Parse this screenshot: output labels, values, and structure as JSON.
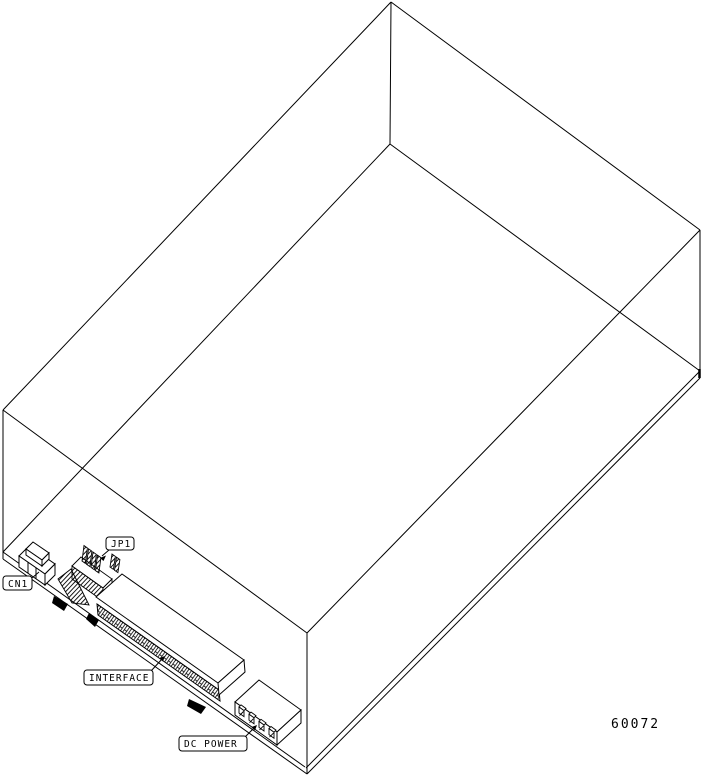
{
  "figure": {
    "labels": {
      "cn1": "CN1",
      "jp1": "JP1",
      "interface": "INTERFACE",
      "dc_power": "DC POWER"
    },
    "figure_number": "60072",
    "colors": {
      "line": "#000000",
      "background": "#ffffff"
    }
  }
}
